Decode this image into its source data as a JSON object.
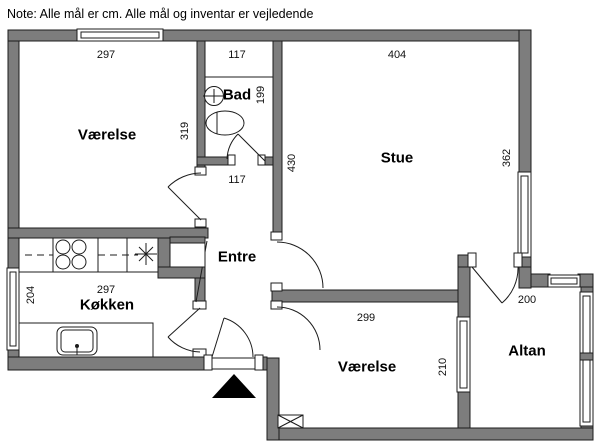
{
  "note": "Note: Alle mål er cm. Alle mål og inventar er vejledende",
  "rooms": {
    "vaerelse1": {
      "label": "Værelse",
      "dim_width": "297",
      "dim_height": "319"
    },
    "bad": {
      "label": "Bad",
      "dim_width_top": "117",
      "dim_height": "199",
      "dim_width_bottom": "117"
    },
    "stue": {
      "label": "Stue",
      "dim_width": "404",
      "dim_height_left": "430",
      "dim_height_right": "362"
    },
    "entre": {
      "label": "Entre"
    },
    "koekken": {
      "label": "Køkken",
      "dim_width": "297",
      "dim_height": "204"
    },
    "vaerelse2": {
      "label": "Værelse",
      "dim_width": "299",
      "dim_height": "210"
    },
    "altan": {
      "label": "Altan",
      "dim_width": "200"
    }
  },
  "colors": {
    "wall": "#7d7d7d",
    "line": "#1c1c1c",
    "background": "#ffffff"
  }
}
